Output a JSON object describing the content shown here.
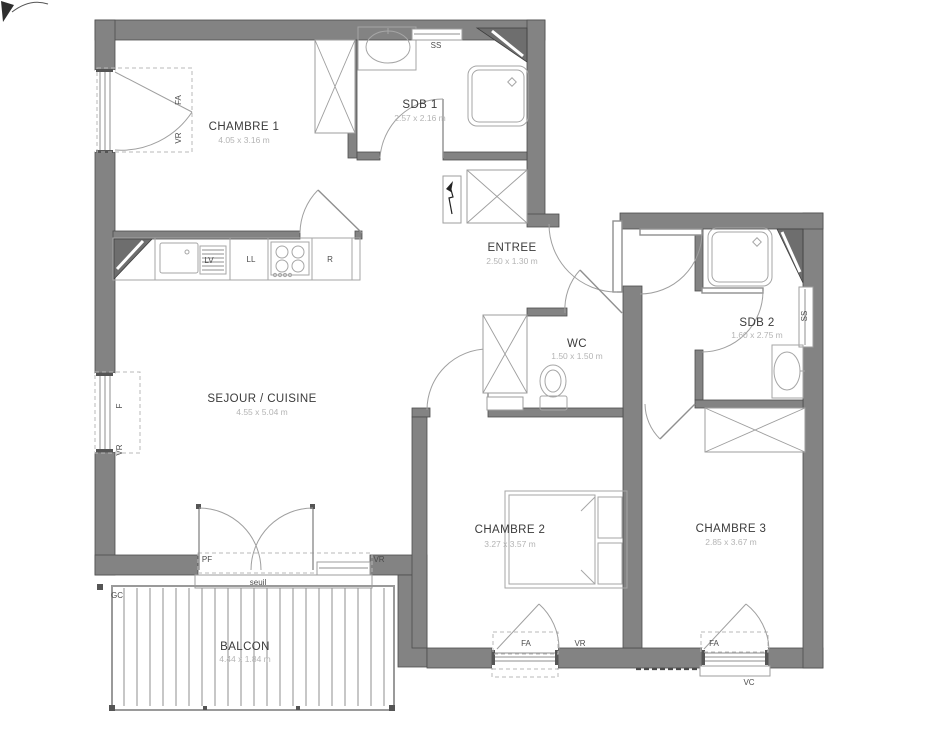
{
  "plan": {
    "title": "apartment-floor-plan",
    "rooms": [
      {
        "id": "chambre1",
        "name": "CHAMBRE 1",
        "dims": "4.05 x 3.16 m"
      },
      {
        "id": "sdb1",
        "name": "SDB 1",
        "dims": "2.57 x 2.16 m"
      },
      {
        "id": "entree",
        "name": "ENTREE",
        "dims": "2.50 x 1.30 m"
      },
      {
        "id": "sejour",
        "name": "SEJOUR / CUISINE",
        "dims": "4.55 x 5.04 m"
      },
      {
        "id": "wc",
        "name": "WC",
        "dims": "1.50 x 1.50 m"
      },
      {
        "id": "sdb2",
        "name": "SDB 2",
        "dims": "1.60 x 2.75 m"
      },
      {
        "id": "chambre2",
        "name": "CHAMBRE 2",
        "dims": "3.27 x 3.57 m"
      },
      {
        "id": "chambre3",
        "name": "CHAMBRE 3",
        "dims": "2.85 x 3.67 m"
      },
      {
        "id": "balcon",
        "name": "BALCON",
        "dims": "4.44 x 1.84 m"
      }
    ],
    "tags": {
      "ss": "SS",
      "lv": "LV",
      "ll": "LL",
      "r": "R",
      "fa": "FA",
      "vr": "VR",
      "f": "F",
      "pf": "PF",
      "vc": "VC",
      "gc": "GC",
      "seuil": "seuil"
    },
    "colors": {
      "wall": "#838383",
      "shaft": "#6e6e6e",
      "room_text": "#3b3b3b",
      "dim_text": "#b4b4b4",
      "fixture_line": "#a6a6a6"
    }
  }
}
